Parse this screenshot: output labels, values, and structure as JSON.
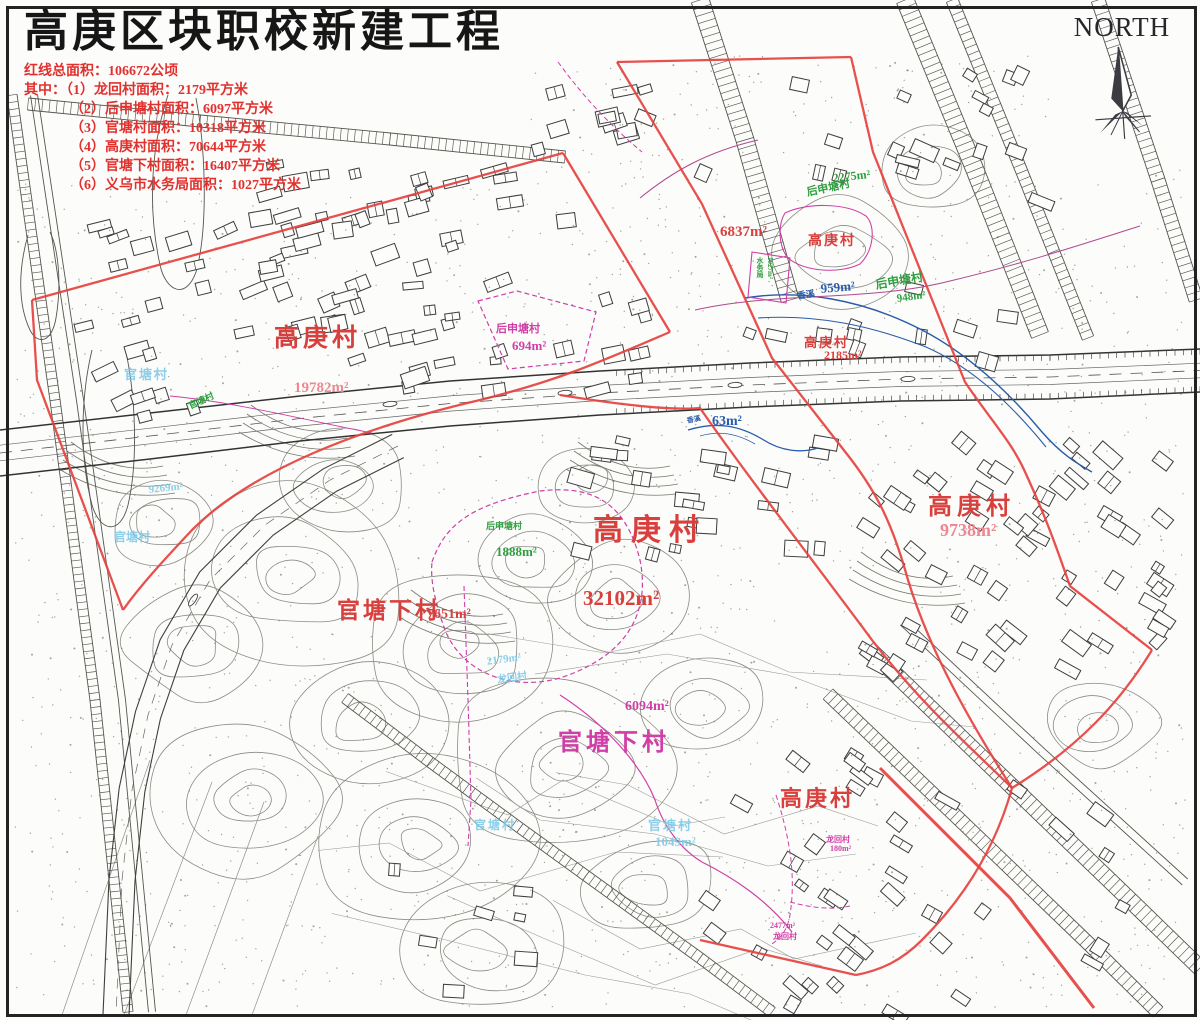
{
  "title": "高庚区块职校新建工程",
  "legend": {
    "total": "红线总面积：106672公顷",
    "items": [
      "其中：（1）龙回村面积：2179平方米",
      "（2）后申塘村面积：6097平方米",
      "（3）官塘村面积：10318平方米",
      "（4）高庚村面积：70644平方米",
      "（5）官塘下村面积：16407平方米",
      "（6）义乌市水务局面积：1027平方米"
    ]
  },
  "compass": {
    "label": "NORTH"
  },
  "colors": {
    "red_line": "#e5413e",
    "label_red": "#d8403e",
    "pink": "#ee8791",
    "magenta": "#cf3fa7",
    "magenta_soft": "#b04890",
    "green": "#2f9e3f",
    "cyan": "#7ec9e6",
    "blue": "#2a5caa",
    "legend_red": "#e0312f"
  },
  "map_labels": [
    {
      "text": "高庚村",
      "color": "red",
      "x": 274,
      "y": 318,
      "fs": 25,
      "ls": 4
    },
    {
      "text": "19782m²",
      "color": "pink",
      "x": 294,
      "y": 380,
      "fs": 15
    },
    {
      "text": "后申塘村",
      "color": "magenta",
      "x": 496,
      "y": 320,
      "fs": 11
    },
    {
      "text": "694m²",
      "color": "magenta",
      "x": 512,
      "y": 338,
      "fs": 13
    },
    {
      "text": "官塘村",
      "color": "cyan",
      "x": 124,
      "y": 364,
      "fs": 13,
      "ls": 2
    },
    {
      "text": "官塘村",
      "color": "green",
      "x": 186,
      "y": 400,
      "fs": 9,
      "rot": -25
    },
    {
      "text": "9269m²",
      "color": "cyan",
      "x": 148,
      "y": 484,
      "fs": 11,
      "rot": -6
    },
    {
      "text": "官塘村",
      "color": "cyan",
      "x": 114,
      "y": 528,
      "fs": 12
    },
    {
      "text": "6837m²",
      "color": "red",
      "x": 720,
      "y": 224,
      "fs": 15
    },
    {
      "text": "高庚村",
      "color": "red",
      "x": 808,
      "y": 230,
      "fs": 14,
      "ls": 2
    },
    {
      "text": "2275m²",
      "color": "green",
      "x": 832,
      "y": 171,
      "fs": 12,
      "rot": -6
    },
    {
      "text": "后申塘村",
      "color": "green",
      "x": 805,
      "y": 184,
      "fs": 11,
      "rot": -12
    },
    {
      "text": "香溪",
      "color": "blue",
      "x": 796,
      "y": 289,
      "fs": 9,
      "rot": -8
    },
    {
      "text": "959m²",
      "color": "blue",
      "x": 820,
      "y": 281,
      "fs": 13,
      "rot": -5
    },
    {
      "text": "后申塘村",
      "color": "green",
      "x": 874,
      "y": 276,
      "fs": 12,
      "rot": -10
    },
    {
      "text": "948m²",
      "color": "green",
      "x": 896,
      "y": 293,
      "fs": 11,
      "rot": -8
    },
    {
      "text": "高庚村",
      "color": "red",
      "x": 804,
      "y": 332,
      "fs": 13,
      "ls": 2
    },
    {
      "text": "2185m²",
      "color": "red",
      "x": 824,
      "y": 348,
      "fs": 12
    },
    {
      "text": "水务局",
      "color": "green",
      "x": 755,
      "y": 257,
      "fs": 7,
      "vert": 1
    },
    {
      "text": "1027m²",
      "color": "green",
      "x": 766,
      "y": 257,
      "fs": 7,
      "vert": 1
    },
    {
      "text": "63m²",
      "color": "blue",
      "x": 712,
      "y": 414,
      "fs": 14
    },
    {
      "text": "香溪",
      "color": "blue",
      "x": 686,
      "y": 416,
      "fs": 7,
      "rot": -10
    },
    {
      "text": "高庚村",
      "color": "red",
      "x": 593,
      "y": 505,
      "fs": 30,
      "ls": 8
    },
    {
      "text": "32102m²",
      "color": "red",
      "x": 583,
      "y": 586,
      "fs": 21
    },
    {
      "text": "后申塘村",
      "color": "green",
      "x": 486,
      "y": 519,
      "fs": 9
    },
    {
      "text": "1888m²",
      "color": "green",
      "x": 496,
      "y": 544,
      "fs": 13
    },
    {
      "text": "官塘下村",
      "color": "red",
      "x": 337,
      "y": 591,
      "fs": 23,
      "ls": 3
    },
    {
      "text": "7651m²",
      "color": "red",
      "x": 427,
      "y": 607,
      "fs": 14
    },
    {
      "text": "2179m²",
      "color": "cyan",
      "x": 486,
      "y": 656,
      "fs": 11,
      "rot": -8
    },
    {
      "text": "龙回村",
      "color": "cyan",
      "x": 496,
      "y": 671,
      "fs": 10,
      "rot": -8
    },
    {
      "text": "官塘下村",
      "color": "magenta",
      "x": 558,
      "y": 722,
      "fs": 24,
      "ls": 4
    },
    {
      "text": "6094m²",
      "color": "magenta",
      "x": 625,
      "y": 699,
      "fs": 14
    },
    {
      "text": "官塘村",
      "color": "cyan",
      "x": 648,
      "y": 815,
      "fs": 13,
      "ls": 2
    },
    {
      "text": "1049m²",
      "color": "cyan",
      "x": 655,
      "y": 834,
      "fs": 13
    },
    {
      "text": "官塘村",
      "color": "cyan",
      "x": 474,
      "y": 816,
      "fs": 12,
      "ls": 2
    },
    {
      "text": "高庚村",
      "color": "red",
      "x": 928,
      "y": 486,
      "fs": 24,
      "ls": 5
    },
    {
      "text": "9738m²",
      "color": "pink",
      "x": 940,
      "y": 520,
      "fs": 18
    },
    {
      "text": "高庚村",
      "color": "red",
      "x": 780,
      "y": 781,
      "fs": 22,
      "ls": 3
    },
    {
      "text": "龙回村",
      "color": "magenta",
      "x": 826,
      "y": 834,
      "fs": 8
    },
    {
      "text": "180m²",
      "color": "magenta",
      "x": 830,
      "y": 844,
      "fs": 8
    },
    {
      "text": "2477m²",
      "color": "magenta",
      "x": 770,
      "y": 921,
      "fs": 8
    },
    {
      "text": "龙回村",
      "color": "magenta",
      "x": 773,
      "y": 931,
      "fs": 8
    }
  ]
}
